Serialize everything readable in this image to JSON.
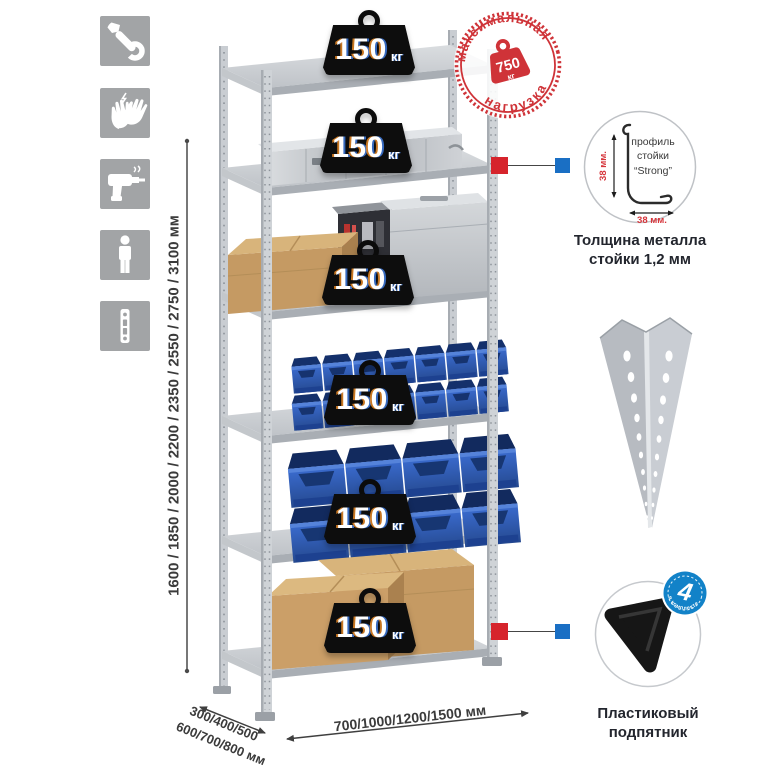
{
  "sidebar": {
    "icons": [
      {
        "id": "wrench-icon"
      },
      {
        "id": "gloves-icon"
      },
      {
        "id": "drill-icon"
      },
      {
        "id": "person-icon"
      },
      {
        "id": "perforated-strip-icon"
      }
    ]
  },
  "rack": {
    "shelf_count": 6,
    "load_value": "150",
    "load_unit": "кг"
  },
  "max_load_stamp": {
    "arc_top": "максимальная",
    "arc_bottom": "нагрузка",
    "value": "750",
    "unit": "кг",
    "color": "#cf3338"
  },
  "dimensions": {
    "height": "1600 / 1850 / 2000 / 2200 / 2350 / 2550 / 2750 / 3100 мм",
    "depth_line1": "300/400/500",
    "depth_line2": "600/700/800 мм",
    "width": "700/1000/1200/1500 мм"
  },
  "profile_detail": {
    "label_line1": "профиль",
    "label_line2": "стойки",
    "label_line3": "“Strong”",
    "dim_vertical": "38 мм.",
    "dim_horizontal": "38 мм.",
    "caption_line1": "Толщина металла",
    "caption_line2": "стойки 1,2 мм"
  },
  "foot_detail": {
    "badge_value": "4",
    "badge_arc": "в комплекте",
    "caption_line1": "Пластиковый",
    "caption_line2": "подпятник",
    "badge_color": "#1282c8"
  },
  "colors": {
    "marker_red": "#d6242c",
    "marker_blue": "#1a6fc4",
    "bin_blue": "#2e5cb8",
    "metal_gray": "#c7cbd0",
    "cardboard": "#c59a63"
  }
}
